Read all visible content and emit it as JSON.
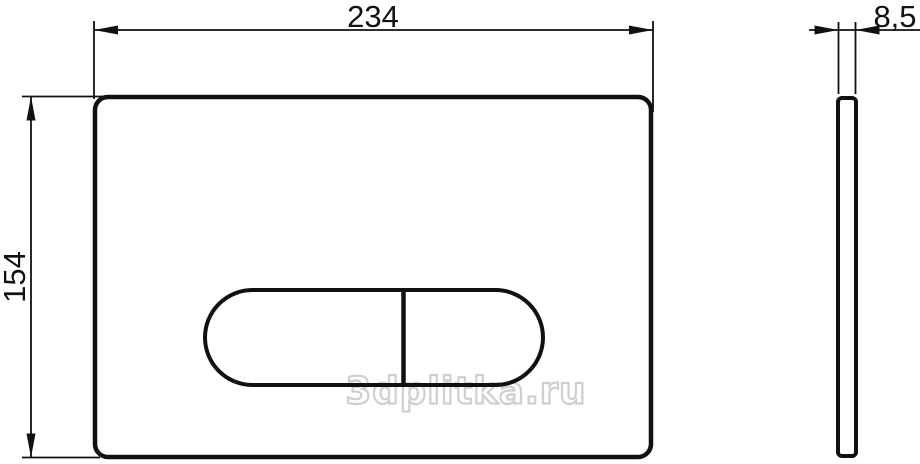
{
  "drawing": {
    "watermark": "3dplitka.ru",
    "dimension_labels": {
      "width": "234",
      "height": "154",
      "thickness": "8,5"
    },
    "colors": {
      "line": "#111111",
      "watermark": "#cfcfcf",
      "background": "#ffffff"
    }
  }
}
